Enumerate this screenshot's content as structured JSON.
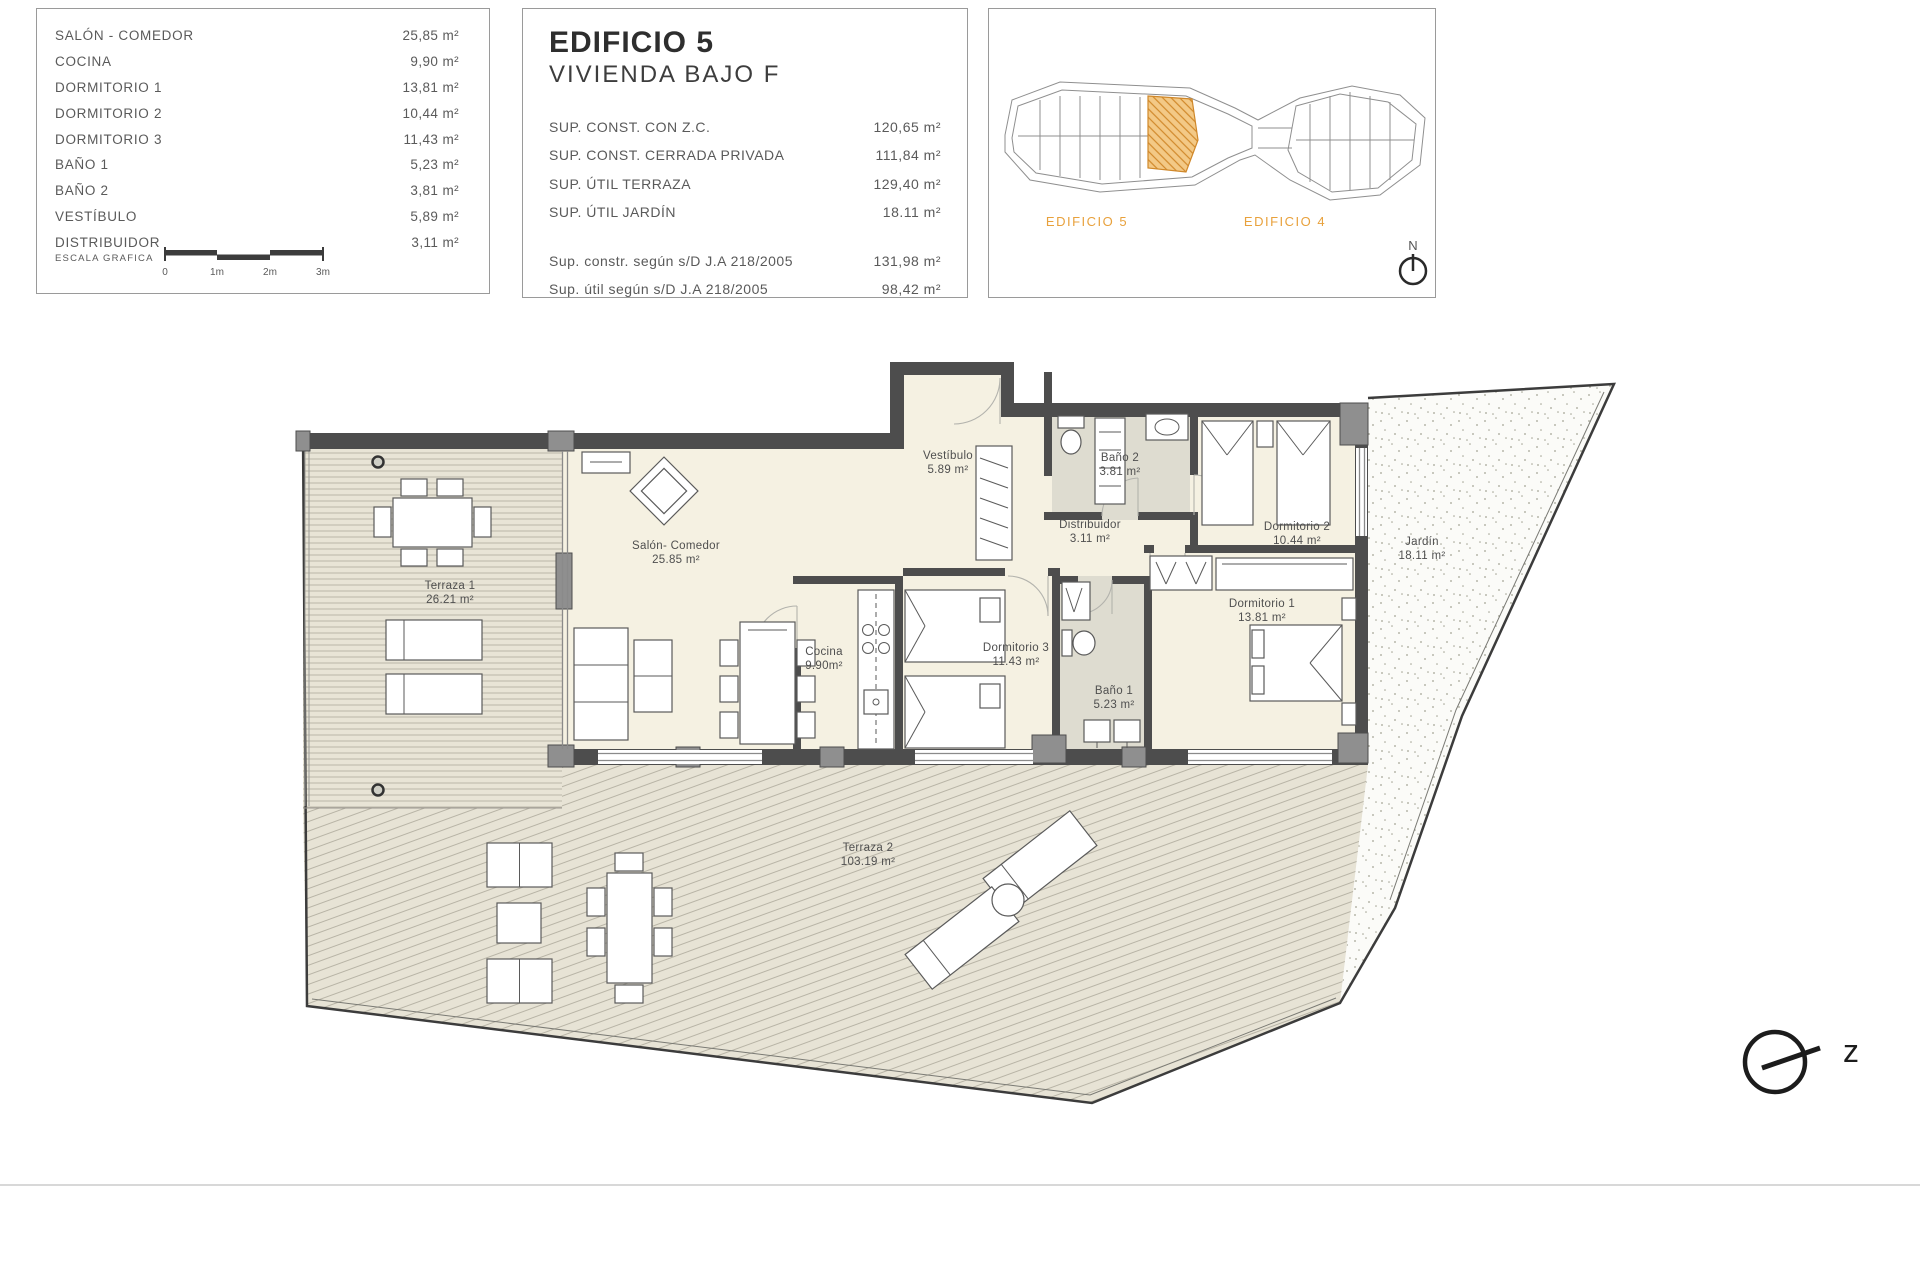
{
  "rooms_panel": {
    "items": [
      {
        "label": "SALÓN - COMEDOR",
        "value": "25,85 m²"
      },
      {
        "label": "COCINA",
        "value": "9,90 m²"
      },
      {
        "label": "DORMITORIO 1",
        "value": "13,81 m²"
      },
      {
        "label": "DORMITORIO 2",
        "value": "10,44 m²"
      },
      {
        "label": "DORMITORIO 3",
        "value": "11,43 m²"
      },
      {
        "label": "BAÑO 1",
        "value": "5,23 m²"
      },
      {
        "label": "BAÑO 2",
        "value": "3,81 m²"
      },
      {
        "label": "VESTÍBULO",
        "value": "5,89 m²"
      },
      {
        "label": "DISTRIBUIDOR",
        "value": "3,11 m²"
      }
    ],
    "scale_label": "ESCALA GRAFICA",
    "scale_ticks": [
      "0",
      "1m",
      "2m",
      "3m"
    ]
  },
  "info_panel": {
    "title": "EDIFICIO 5",
    "subtitle": "VIVIENDA BAJO F",
    "rows": [
      {
        "label": "SUP. CONST. CON Z.C.",
        "value": "120,65 m²"
      },
      {
        "label": "SUP. CONST. CERRADA PRIVADA",
        "value": "111,84 m²"
      },
      {
        "label": "SUP. ÚTIL TERRAZA",
        "value": "129,40 m²"
      },
      {
        "label": "SUP. ÚTIL JARDÍN",
        "value": "18.11 m²"
      }
    ],
    "rows2": [
      {
        "label": "Sup. constr. según s/D J.A 218/2005",
        "value": "131,98 m²"
      },
      {
        "label": "Sup. útil según s/D J.A 218/2005",
        "value": "98,42 m²"
      }
    ]
  },
  "site_panel": {
    "building_left": "EDIFICIO 5",
    "building_right": "EDIFICIO 4",
    "north_label": "N",
    "accent_color": "#e8a13c"
  },
  "plan": {
    "rooms": [
      {
        "name": "terraza-1",
        "label": "Terraza 1",
        "area": "26.21 m²"
      },
      {
        "name": "salon-comedor",
        "label": "Salón- Comedor",
        "area": "25.85 m²"
      },
      {
        "name": "cocina",
        "label": "Cocina",
        "area": "9.90m²"
      },
      {
        "name": "vestibulo",
        "label": "Vestíbulo",
        "area": "5.89 m²"
      },
      {
        "name": "bano-2",
        "label": "Baño 2",
        "area": "3.81 m²"
      },
      {
        "name": "distribuidor",
        "label": "Distribuidor",
        "area": "3.11 m²"
      },
      {
        "name": "dormitorio-2",
        "label": "Dormitorio 2",
        "area": "10.44 m²"
      },
      {
        "name": "dormitorio-1",
        "label": "Dormitorio 1",
        "area": "13.81 m²"
      },
      {
        "name": "dormitorio-3",
        "label": "Dormitorio 3",
        "area": "11.43 m²"
      },
      {
        "name": "bano-1",
        "label": "Baño 1",
        "area": "5.23 m²"
      },
      {
        "name": "jardin",
        "label": "Jardín",
        "area": "18.11 m²"
      },
      {
        "name": "terraza-2",
        "label": "Terraza 2",
        "area": "103.19 m²"
      }
    ],
    "north_mark": "z"
  }
}
